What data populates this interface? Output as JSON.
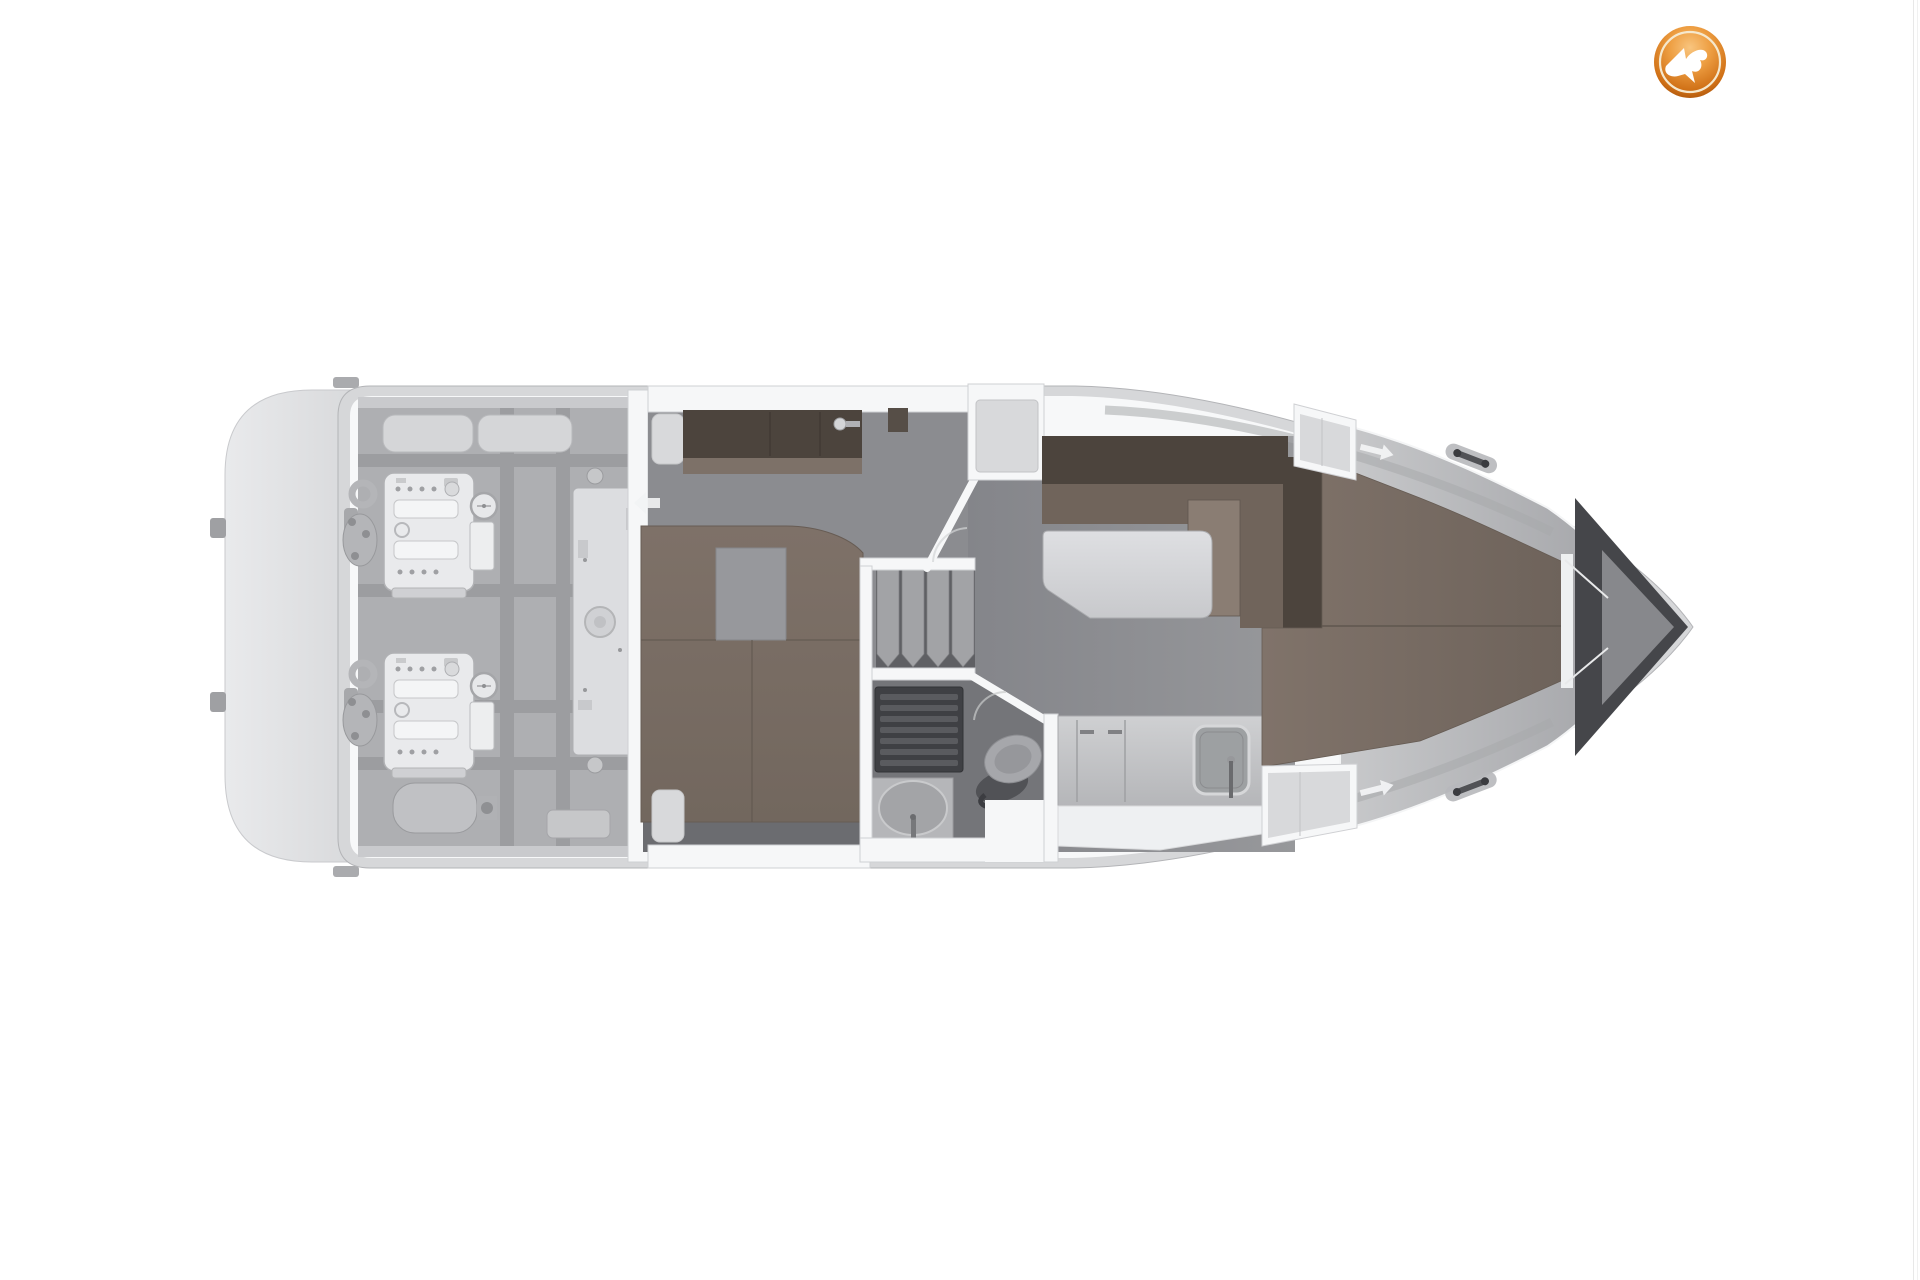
{
  "meta": {
    "description": "Top-view floor plan rendering of a motor yacht lower deck on a white background, bow pointing right, with a circular orange broker watermark logo in the top-right corner",
    "canvas": {
      "width": 1920,
      "height": 1280
    }
  },
  "logo": {
    "name": "broker-watermark-seagull-logo",
    "shape": "circular glossy badge",
    "bird_color": "#ffffff",
    "ring_color": "#f5e8cd",
    "orange_top": "#f6b96a",
    "orange_bottom": "#9a4a08",
    "position": "top-right"
  },
  "floor_plan": {
    "orientation": "bow-right",
    "areas": [
      {
        "id": "swim-platform",
        "label": "Swim platform at stern"
      },
      {
        "id": "engine-room",
        "label": "Engine room with twin engines, stringer grid, tank and muffler"
      },
      {
        "id": "aft-cabin",
        "label": "Aft cabin with double berth and wardrobe"
      },
      {
        "id": "companionway",
        "label": "Companionway stairs down from salon"
      },
      {
        "id": "head",
        "label": "Bathroom with shower grate, washbasin and toilet"
      },
      {
        "id": "salon",
        "label": "Salon with L-shaped dinette and table"
      },
      {
        "id": "galley",
        "label": "Galley with sink, faucet and refrigerator"
      },
      {
        "id": "fore-cabin",
        "label": "Forward cabin with tapered V-berth"
      },
      {
        "id": "anchor-locker",
        "label": "Anchor locker wedge at bow tip"
      }
    ],
    "fixtures": [
      "engine-port",
      "engine-starboard",
      "generator-tank",
      "muffler",
      "deck-hatch",
      "deck-fitting",
      "stairs",
      "shower-grate",
      "washbasin",
      "toilet",
      "dinette-seat",
      "dinette-table",
      "galley-counter",
      "galley-sink",
      "wardrobe",
      "double-berth",
      "v-berth",
      "cleat",
      "walkway-arrow",
      "door-swing-arc",
      "window-cutout"
    ],
    "colors": {
      "background": "#ffffff",
      "hull": "#d6d7d9",
      "hull-stroke": "#b3b4b7",
      "deck": "#f7f8f9",
      "platform-edge": "#cdced1",
      "strut": "#9fa0a3",
      "engine-floor": "#aeafb2",
      "floor-lip": "#c9cacd",
      "beam": "#9c9da0",
      "tank": "#dcdde0",
      "tank-stroke": "#aeafb2",
      "hatch": "#d5d6d8",
      "hatch-stroke": "#b8b9bc",
      "fitting": "#c6c7c9",
      "fitting-stroke": "#9b9c9f",
      "muffler": "#c0c1c4",
      "wall": "#f6f7f8",
      "wall-stroke": "#cfd0d3",
      "window": "#d8d9db",
      "aft-floor": "#8b8c90",
      "bath-floor": "#747579",
      "stairs-gap": "#5f6064",
      "stair": "#a2a3a6",
      "stair-stroke": "#7f8083",
      "grate": "#3f4044",
      "grate-rib": "#5a5b5f",
      "counter-basin": "#b5b6b9",
      "basin": "#a3a4a7",
      "toilet-seat": "#a6a7ab",
      "dark-fitting": "#515256",
      "brown-dark": "#4c443d",
      "brown-mid": "#70645b",
      "brown-light": "#8a7d73",
      "brown-bed": "#7b6e66",
      "seam": "#5f564e",
      "bed-shadow": "#6b6c70",
      "sink-inner": "#9da0a2",
      "sink-rim": "#d6d7d9",
      "wedge": "#45464a",
      "wedge-light": "#8b8c8f",
      "arrow": "#f2f3f4",
      "engine-white": "#e9eaec",
      "engine-stroke": "#b0b1b4",
      "engine-part": "#b4b5b8",
      "gunwale-shade": "#a8a9ac",
      "edge-line": "#e8e8e8"
    }
  }
}
